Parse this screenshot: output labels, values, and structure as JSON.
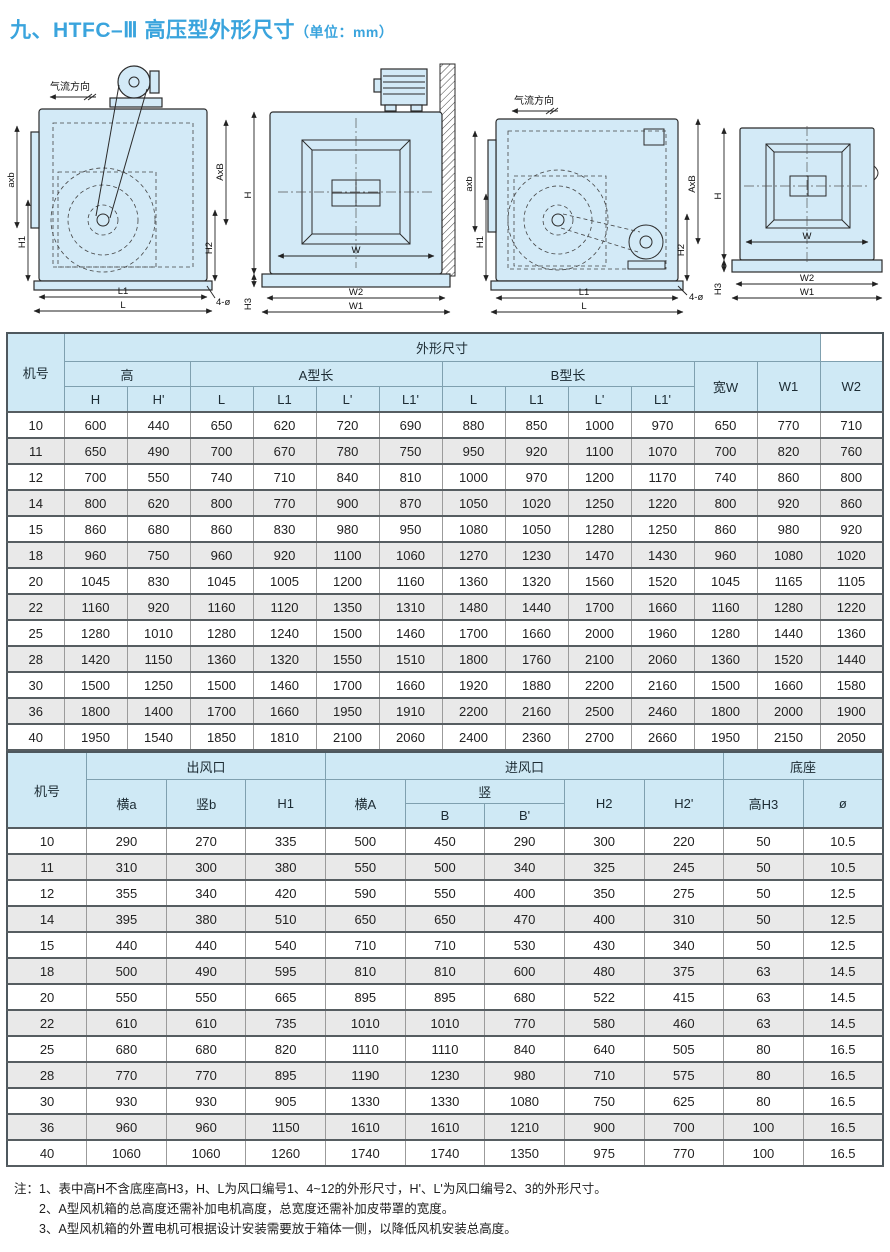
{
  "title": {
    "main": "九、HTFC–Ⅲ 高压型外形尺寸",
    "unit": "（单位：mm）"
  },
  "drawings": {
    "airflow_label": "气流方向",
    "side_dims": {
      "outlet": "axb",
      "h1": "H1",
      "inlet": "AxB",
      "h2": "H2",
      "l1": "L1",
      "l": "L",
      "holes": "4-ø"
    },
    "front_dims": {
      "h": "H",
      "w": "W",
      "w2": "W2",
      "w1": "W1",
      "h3": "H3"
    }
  },
  "table1": {
    "title": "外形尺寸",
    "col_machine": "机号",
    "group_height": "高",
    "group_a": "A型长",
    "group_b": "B型长",
    "col_w": "宽W",
    "col_w1": "W1",
    "col_w2": "W2",
    "sub": [
      "H",
      "H'",
      "L",
      "L1",
      "L'",
      "L1'",
      "L",
      "L1",
      "L'",
      "L1'"
    ],
    "rows": [
      [
        "10",
        600,
        440,
        650,
        620,
        720,
        690,
        880,
        850,
        1000,
        970,
        650,
        770,
        710
      ],
      [
        "11",
        650,
        490,
        700,
        670,
        780,
        750,
        950,
        920,
        1100,
        1070,
        700,
        820,
        760
      ],
      [
        "12",
        700,
        550,
        740,
        710,
        840,
        810,
        1000,
        970,
        1200,
        1170,
        740,
        860,
        800
      ],
      [
        "14",
        800,
        620,
        800,
        770,
        900,
        870,
        1050,
        1020,
        1250,
        1220,
        800,
        920,
        860
      ],
      [
        "15",
        860,
        680,
        860,
        830,
        980,
        950,
        1080,
        1050,
        1280,
        1250,
        860,
        980,
        920
      ],
      [
        "18",
        960,
        750,
        960,
        920,
        1100,
        1060,
        1270,
        1230,
        1470,
        1430,
        960,
        1080,
        1020
      ],
      [
        "20",
        1045,
        830,
        1045,
        1005,
        1200,
        1160,
        1360,
        1320,
        1560,
        1520,
        1045,
        1165,
        1105
      ],
      [
        "22",
        1160,
        920,
        1160,
        1120,
        1350,
        1310,
        1480,
        1440,
        1700,
        1660,
        1160,
        1280,
        1220
      ],
      [
        "25",
        1280,
        1010,
        1280,
        1240,
        1500,
        1460,
        1700,
        1660,
        2000,
        1960,
        1280,
        1440,
        1360
      ],
      [
        "28",
        1420,
        1150,
        1360,
        1320,
        1550,
        1510,
        1800,
        1760,
        2100,
        2060,
        1360,
        1520,
        1440
      ],
      [
        "30",
        1500,
        1250,
        1500,
        1460,
        1700,
        1660,
        1920,
        1880,
        2200,
        2160,
        1500,
        1660,
        1580
      ],
      [
        "36",
        1800,
        1400,
        1700,
        1660,
        1950,
        1910,
        2200,
        2160,
        2500,
        2460,
        1800,
        2000,
        1900
      ],
      [
        "40",
        1950,
        1540,
        1850,
        1810,
        2100,
        2060,
        2400,
        2360,
        2700,
        2660,
        1950,
        2150,
        2050
      ]
    ]
  },
  "table2": {
    "col_machine": "机号",
    "group_outlet": "出风口",
    "group_inlet": "进风口",
    "group_base": "底座",
    "col_ha": "横a",
    "col_vb": "竖b",
    "col_h1": "H1",
    "col_hA": "横A",
    "group_v": "竖",
    "col_B": "B",
    "col_Bp": "B'",
    "col_h2": "H2",
    "col_h2p": "H2'",
    "col_h3": "高H3",
    "col_dia": "ø",
    "rows": [
      [
        "10",
        290,
        270,
        335,
        500,
        450,
        290,
        300,
        220,
        50,
        10.5
      ],
      [
        "11",
        310,
        300,
        380,
        550,
        500,
        340,
        325,
        245,
        50,
        10.5
      ],
      [
        "12",
        355,
        340,
        420,
        590,
        550,
        400,
        350,
        275,
        50,
        12.5
      ],
      [
        "14",
        395,
        380,
        510,
        650,
        650,
        470,
        400,
        310,
        50,
        12.5
      ],
      [
        "15",
        440,
        440,
        540,
        710,
        710,
        530,
        430,
        340,
        50,
        12.5
      ],
      [
        "18",
        500,
        490,
        595,
        810,
        810,
        600,
        480,
        375,
        63,
        14.5
      ],
      [
        "20",
        550,
        550,
        665,
        895,
        895,
        680,
        522,
        415,
        63,
        14.5
      ],
      [
        "22",
        610,
        610,
        735,
        1010,
        1010,
        770,
        580,
        460,
        63,
        14.5
      ],
      [
        "25",
        680,
        680,
        820,
        1110,
        1110,
        840,
        640,
        505,
        80,
        16.5
      ],
      [
        "28",
        770,
        770,
        895,
        1190,
        1230,
        980,
        710,
        575,
        80,
        16.5
      ],
      [
        "30",
        930,
        930,
        905,
        1330,
        1330,
        1080,
        750,
        625,
        80,
        16.5
      ],
      [
        "36",
        960,
        960,
        1150,
        1610,
        1610,
        1210,
        900,
        700,
        100,
        16.5
      ],
      [
        "40",
        1060,
        1060,
        1260,
        1740,
        1740,
        1350,
        975,
        770,
        100,
        16.5
      ]
    ]
  },
  "notes": {
    "prefix": "注：",
    "lines": [
      "1、表中高H不含底座高H3，H、L为风口编号1、4~12的外形尺寸，H'、L'为风口编号2、3的外形尺寸。",
      "2、A型风机箱的总高度还需补加电机高度，总宽度还需补加皮带罩的宽度。",
      "3、A型风机箱的外置电机可根据设计安装需要放于箱体一侧，以降低风机安装总高度。"
    ]
  },
  "colors": {
    "accent": "#3aa4dd",
    "header_bg": "#cfe9f5",
    "row_alt_bg": "#e9e9e9",
    "drawing_fill": "#d3eaf7"
  }
}
